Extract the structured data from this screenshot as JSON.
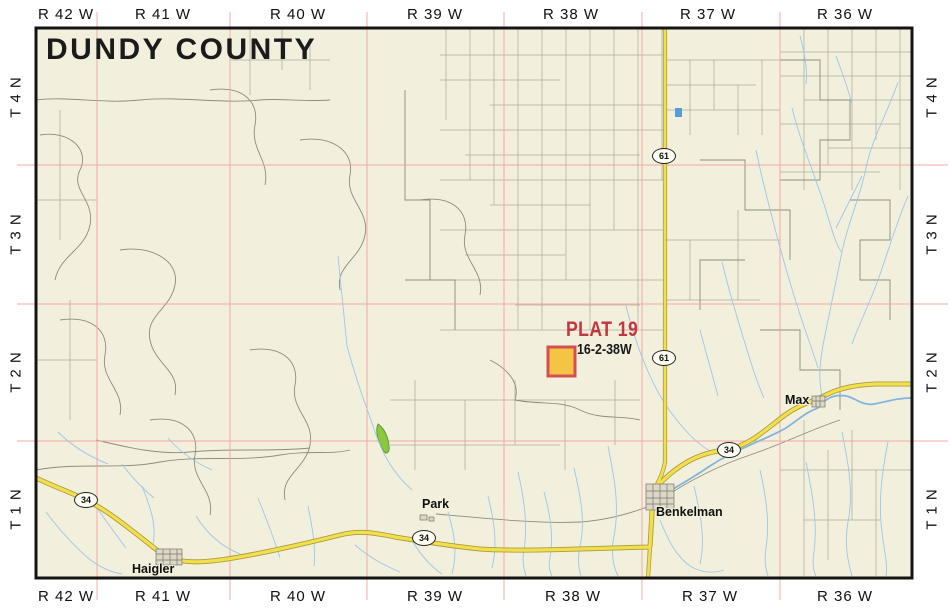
{
  "title": "DUNDY COUNTY",
  "ranges": [
    "R 42 W",
    "R 41 W",
    "R 40 W",
    "R 39 W",
    "R 38 W",
    "R 37 W",
    "R 36 W"
  ],
  "townships": [
    "T 4 N",
    "T 3 N",
    "T 2 N",
    "T 1 N"
  ],
  "plat": {
    "name": "PLAT 19",
    "section_township_range": "16-2-38W"
  },
  "towns": {
    "haigler": "Haigler",
    "park": "Park",
    "benkelman": "Benkelman",
    "max": "Max"
  },
  "highways": {
    "h61": "61",
    "h34": "34"
  },
  "colors": {
    "map_background": "#f2efdc",
    "grid_red": "#f2a49c",
    "section_gray": "#b2af9f",
    "parcel_gray": "#8f8c7e",
    "stream_blue": "#9ec7e6",
    "highway_yellow": "#f3df4e",
    "highway_casing": "#ab9f3d",
    "plat_fill": "#f6c445",
    "plat_border": "#d44f4f",
    "plat_text_red": "#c53540",
    "wetland_green": "#8dc63f"
  }
}
